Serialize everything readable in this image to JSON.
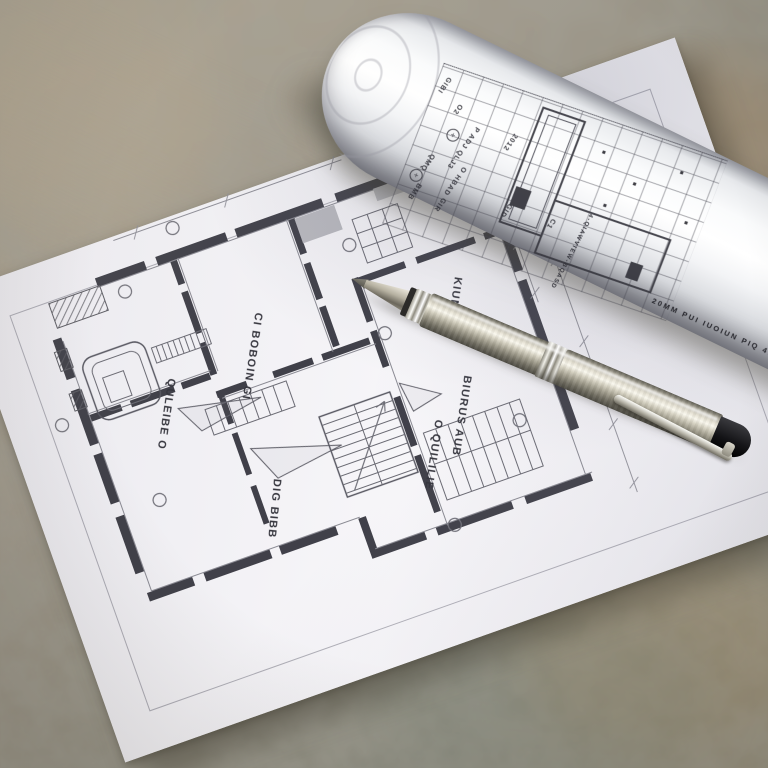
{
  "scene": {
    "type": "photograph",
    "description": "Architectural floor-plan sheet and a rolled blueprint lying on a granite stone surface with a stainless steel ballpoint pen resting diagonally across the drawing",
    "surface": "granite stone",
    "objects": [
      "floor-plan-sheet",
      "blueprint-roll",
      "ballpoint-pen"
    ]
  },
  "floor_plan": {
    "sheet": "white paper with thin inner border frame",
    "labels": [
      {
        "id": "room-label-1",
        "text": "CI BOBOIN GI"
      },
      {
        "id": "room-label-2",
        "text": "QULEIBE O"
      },
      {
        "id": "room-label-3",
        "text": "DIG BIBB"
      },
      {
        "id": "room-label-4",
        "text": "O QUILILIE"
      },
      {
        "id": "room-label-5",
        "text": "BIURUS AUB"
      },
      {
        "id": "room-label-6",
        "text": "KIUMILIB"
      }
    ],
    "features": [
      "thick segmented walls",
      "stair flight with treads",
      "door swing triangles",
      "bathtub fixture",
      "wardrobe grids",
      "hatched blocks",
      "grid marker circles",
      "dimension lines"
    ]
  },
  "blueprint_roll": {
    "table_labels": [
      {
        "text": "2012"
      },
      {
        "text": "GIBI"
      },
      {
        "text": "O2"
      },
      {
        "text": "P ADJ QLJ3"
      },
      {
        "text": "O HBAD"
      },
      {
        "text": "QMQ"
      },
      {
        "text": "BMB"
      },
      {
        "text": "GIR"
      },
      {
        "text": "GID"
      },
      {
        "text": "C1"
      }
    ],
    "side_text": "20MM PUI IUOIUN PIQ 410 GIO 05",
    "vertical_text": "4-QIAWVIEW-BQASD"
  },
  "pen": {
    "type": "stainless steel ballpoint pen",
    "finish": "brushed steel barrel",
    "details": [
      "chrome rings",
      "metal clip",
      "black rear grip",
      "conical tip"
    ]
  },
  "colors": {
    "paper": "#f4f3f6",
    "plan_ink": "#3f3f45",
    "stone_base": "#9a9486",
    "stone_green": "#8e9184",
    "stone_tan": "#ab8a62",
    "pen_steel": "#c9c5b6",
    "pen_rear": "#1b1b1e",
    "chrome": "#f2f2ee"
  }
}
